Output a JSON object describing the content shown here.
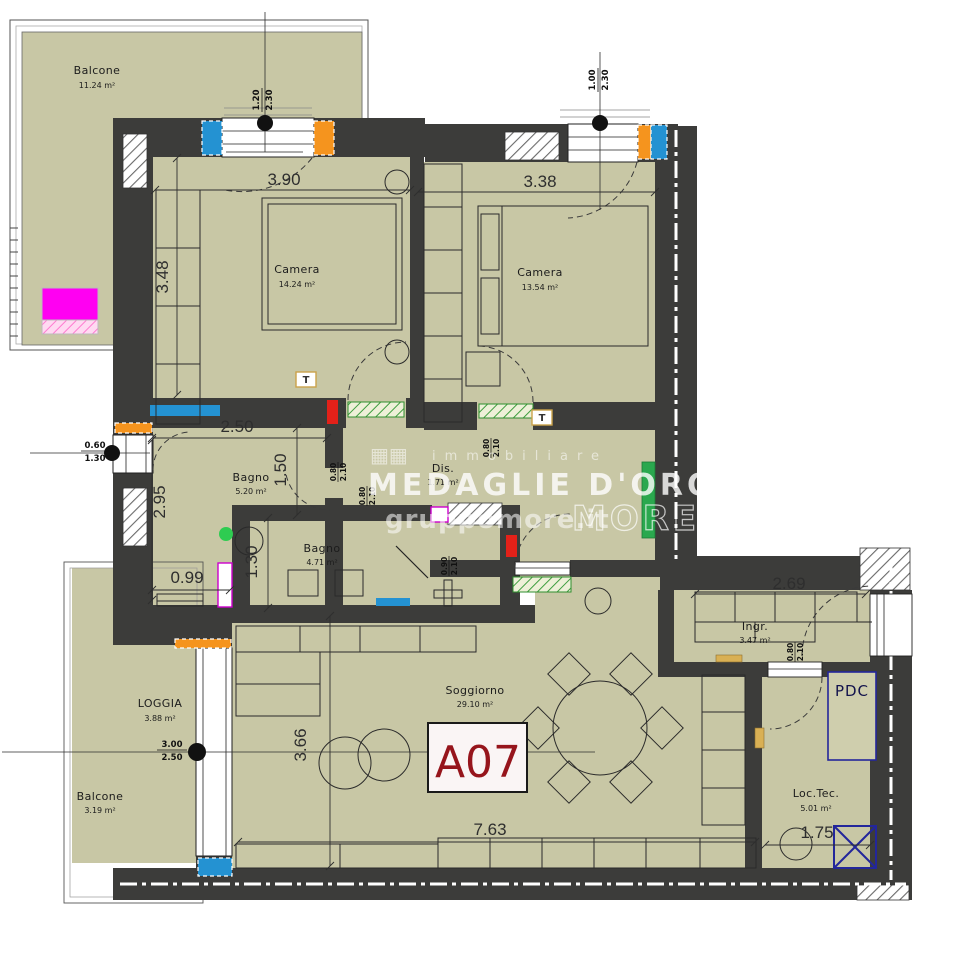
{
  "meta": {
    "unit_label": "A07"
  },
  "watermark": {
    "word": "immobiliare",
    "brand": "MEDAGLIE D'ORO",
    "site": "gruppomore.it",
    "logo": "MORE",
    "logo_icon": "▦▦"
  },
  "rooms": {
    "balcone_top": {
      "name": "Balcone",
      "area": "11.24 m²"
    },
    "camera1": {
      "name": "Camera",
      "area": "14.24 m²"
    },
    "camera2": {
      "name": "Camera",
      "area": "13.54 m²"
    },
    "bagno1": {
      "name": "Bagno",
      "area": "5.20 m²"
    },
    "bagno2": {
      "name": "Bagno",
      "area": "4.71 m²"
    },
    "dis": {
      "name": "Dis.",
      "area": "1.71 m²"
    },
    "ingresso": {
      "name": "Ingr.",
      "area": "3.47 m²"
    },
    "soggiorno": {
      "name": "Soggiorno",
      "area": "29.10 m²"
    },
    "loctec": {
      "name": "Loc.Tec.",
      "area": "5.01 m²"
    },
    "loggia": {
      "name": "LOGGIA",
      "area": "3.88 m²"
    },
    "balcone_bottom": {
      "name": "Balcone",
      "area": "3.19 m²"
    }
  },
  "labels": {
    "pdc": "PDC",
    "thermo": "T"
  },
  "dims": {
    "cam1_w": "3.90",
    "cam2_w": "3.38",
    "cam1_h": "3.48",
    "bagno1_w": "2.50",
    "bagno1_d": "1.50",
    "left_h": "2.95",
    "bagno1_low": "0.99",
    "bagno2_nook": "1.30",
    "ingr_w": "2.69",
    "sogg_h": "3.66",
    "sogg_w": "7.63",
    "loctec_w": "1.75"
  },
  "openings": {
    "win_top_left": [
      "1.20",
      "2.30"
    ],
    "win_top_right": [
      "1.00",
      "2.30"
    ],
    "win_left": [
      "0.60",
      "1.30"
    ],
    "win_loggia": [
      "3.00",
      "2.50"
    ],
    "door_bagno1": [
      "0.80",
      "2.10"
    ],
    "door_camera2": [
      "0.80",
      "2.10"
    ],
    "door_bagno2": [
      "0.80",
      "2.10"
    ],
    "door_soggiorno": [
      "0.90",
      "2.10"
    ],
    "door_loctec": [
      "0.80",
      "2.10"
    ]
  },
  "colors": {
    "room_fill": "#c8c7a5",
    "wall": "#3c3c3a",
    "marker_blue": "#2492d2",
    "marker_orange": "#f5941e",
    "radiator_green": "#2aa84e",
    "alert_red": "#e32119",
    "magenta": "#ff00f2",
    "unit_red": "#96151c",
    "pdc_blue": "#23269b"
  }
}
